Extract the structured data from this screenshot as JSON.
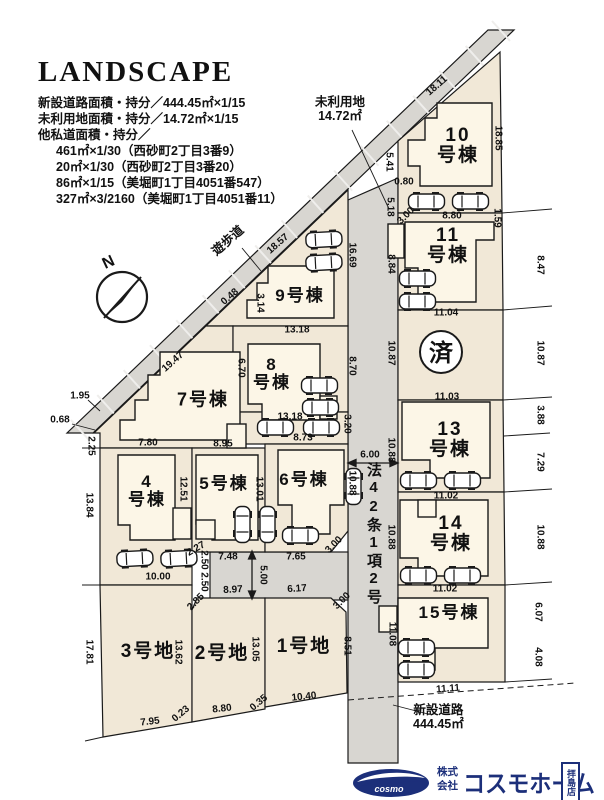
{
  "header": {
    "title": "LANDSCAPE",
    "lines": [
      "新設道路面積・持分／444.45㎡×1/15",
      "未利用地面積・持分／14.72㎡×1/15",
      "他私道面積・持分／",
      "461㎡×1/30（西砂町2丁目3番9）",
      "20㎡×1/30（西砂町2丁目3番20）",
      "86㎡×1/15（美堀町1丁目4051番547）",
      "327㎡×3/2160（美堀町1丁目4051番11）"
    ]
  },
  "plan": {
    "north_label": "N",
    "walkway_label": "遊歩道",
    "unused_label_1": "未利用地",
    "unused_label_2": "14.72㎡",
    "road42_label": "法42条1項2号",
    "newroad_label_1": "新設道路",
    "newroad_label_2": "444.45㎡",
    "sold_label": "済",
    "colors": {
      "lot": "#f1e8d7",
      "road": "#d8d6d1",
      "house": "#fcf6e7",
      "line": "#1a1a1a",
      "logo_navy": "#1c2f7a"
    },
    "parcels": [
      {
        "lines": [
          "10",
          "号棟"
        ],
        "x": 458,
        "y": 146,
        "size": 19
      },
      {
        "lines": [
          "11",
          "号棟"
        ],
        "x": 448,
        "y": 246,
        "size": 19
      },
      {
        "lines": [
          "13",
          "号棟"
        ],
        "x": 450,
        "y": 440,
        "size": 19
      },
      {
        "lines": [
          "14",
          "号棟"
        ],
        "x": 451,
        "y": 534,
        "size": 19
      },
      {
        "lines": [
          "15号棟"
        ],
        "x": 449,
        "y": 613,
        "size": 17
      },
      {
        "lines": [
          "9号棟"
        ],
        "x": 300,
        "y": 296,
        "size": 17
      },
      {
        "lines": [
          "8",
          "号棟"
        ],
        "x": 272,
        "y": 374,
        "size": 17
      },
      {
        "lines": [
          "7号棟"
        ],
        "x": 203,
        "y": 400,
        "size": 18
      },
      {
        "lines": [
          "4",
          "号棟"
        ],
        "x": 147,
        "y": 491,
        "size": 17
      },
      {
        "lines": [
          "5号棟"
        ],
        "x": 224,
        "y": 484,
        "size": 17
      },
      {
        "lines": [
          "6号棟"
        ],
        "x": 304,
        "y": 480,
        "size": 17
      },
      {
        "lines": [
          "3号地"
        ],
        "x": 148,
        "y": 652,
        "size": 19
      },
      {
        "lines": [
          "2号地"
        ],
        "x": 222,
        "y": 654,
        "size": 19
      },
      {
        "lines": [
          "1号地"
        ],
        "x": 304,
        "y": 647,
        "size": 19
      }
    ],
    "dimensions": [
      {
        "t": "18.11",
        "x": 437,
        "y": 86,
        "r": -41
      },
      {
        "t": "18.57",
        "x": 278,
        "y": 244,
        "r": -41
      },
      {
        "t": "0.48",
        "x": 230,
        "y": 297,
        "r": -41
      },
      {
        "t": "19.47",
        "x": 173,
        "y": 362,
        "r": -41
      },
      {
        "t": "1.95",
        "x": 80,
        "y": 396,
        "r": 0
      },
      {
        "t": "0.68",
        "x": 60,
        "y": 420,
        "r": 0
      },
      {
        "t": "2.25",
        "x": 91,
        "y": 446,
        "r": 90
      },
      {
        "t": "13.84",
        "x": 89,
        "y": 505,
        "r": 90
      },
      {
        "t": "17.81",
        "x": 89,
        "y": 652,
        "r": 90
      },
      {
        "t": "7.95",
        "x": 150,
        "y": 722,
        "r": -6
      },
      {
        "t": "0.23",
        "x": 181,
        "y": 714,
        "r": -40
      },
      {
        "t": "8.80",
        "x": 222,
        "y": 709,
        "r": -6
      },
      {
        "t": "0.35",
        "x": 259,
        "y": 703,
        "r": -40
      },
      {
        "t": "10.40",
        "x": 304,
        "y": 697,
        "r": -6
      },
      {
        "t": "13.62",
        "x": 178,
        "y": 652,
        "r": 90
      },
      {
        "t": "13.05",
        "x": 255,
        "y": 649,
        "r": 90
      },
      {
        "t": "8.51",
        "x": 347,
        "y": 646,
        "r": 90
      },
      {
        "t": "2.85",
        "x": 196,
        "y": 602,
        "r": -45
      },
      {
        "t": "3.00",
        "x": 342,
        "y": 601,
        "r": -45
      },
      {
        "t": "6.17",
        "x": 297,
        "y": 589,
        "r": -4
      },
      {
        "t": "8.97",
        "x": 233,
        "y": 590,
        "r": -3
      },
      {
        "t": "7.48",
        "x": 228,
        "y": 557,
        "r": 0
      },
      {
        "t": "7.65",
        "x": 296,
        "y": 557,
        "r": 0
      },
      {
        "t": "5.00",
        "x": 263,
        "y": 575,
        "r": 90
      },
      {
        "t": "2.50",
        "x": 204,
        "y": 560,
        "r": 90
      },
      {
        "t": "2.50",
        "x": 204,
        "y": 582,
        "r": 90
      },
      {
        "t": "10.00",
        "x": 158,
        "y": 577,
        "r": 0
      },
      {
        "t": "2.27",
        "x": 196,
        "y": 549,
        "r": -30
      },
      {
        "t": "7.80",
        "x": 148,
        "y": 443,
        "r": 0
      },
      {
        "t": "8.95",
        "x": 223,
        "y": 444,
        "r": 0
      },
      {
        "t": "8.73",
        "x": 303,
        "y": 438,
        "r": 0
      },
      {
        "t": "12.51",
        "x": 183,
        "y": 489,
        "r": 90
      },
      {
        "t": "13.01",
        "x": 259,
        "y": 489,
        "r": 90
      },
      {
        "t": "3.00",
        "x": 334,
        "y": 545,
        "r": -45
      },
      {
        "t": "3.20",
        "x": 347,
        "y": 424,
        "r": 90
      },
      {
        "t": "10.88",
        "x": 352,
        "y": 483,
        "r": 90
      },
      {
        "t": "6.00",
        "x": 370,
        "y": 455,
        "r": 0
      },
      {
        "t": "3.14",
        "x": 260,
        "y": 303,
        "r": 90
      },
      {
        "t": "13.18",
        "x": 297,
        "y": 330,
        "r": 0
      },
      {
        "t": "13.18",
        "x": 290,
        "y": 417,
        "r": 0
      },
      {
        "t": "6.70",
        "x": 241,
        "y": 368,
        "r": 90
      },
      {
        "t": "8.70",
        "x": 352,
        "y": 366,
        "r": 90
      },
      {
        "t": "16.69",
        "x": 352,
        "y": 255,
        "r": 90
      },
      {
        "t": "5.41",
        "x": 389,
        "y": 162,
        "r": 90
      },
      {
        "t": "0.80",
        "x": 404,
        "y": 182,
        "r": 0
      },
      {
        "t": "5.18",
        "x": 390,
        "y": 207,
        "r": 90
      },
      {
        "t": "3.00",
        "x": 406,
        "y": 216,
        "r": -45
      },
      {
        "t": "8.84",
        "x": 391,
        "y": 264,
        "r": 90
      },
      {
        "t": "10.87",
        "x": 391,
        "y": 353,
        "r": 90
      },
      {
        "t": "10.88",
        "x": 391,
        "y": 450,
        "r": 90
      },
      {
        "t": "10.88",
        "x": 391,
        "y": 537,
        "r": 90
      },
      {
        "t": "11.08",
        "x": 392,
        "y": 634,
        "r": 90
      },
      {
        "t": "18.85",
        "x": 498,
        "y": 138,
        "r": 90
      },
      {
        "t": "1.59",
        "x": 497,
        "y": 218,
        "r": 90
      },
      {
        "t": "8.47",
        "x": 540,
        "y": 265,
        "r": 90
      },
      {
        "t": "10.87",
        "x": 540,
        "y": 353,
        "r": 90
      },
      {
        "t": "3.88",
        "x": 540,
        "y": 415,
        "r": 90
      },
      {
        "t": "7.29",
        "x": 540,
        "y": 462,
        "r": 90
      },
      {
        "t": "10.88",
        "x": 540,
        "y": 537,
        "r": 90
      },
      {
        "t": "6.07",
        "x": 538,
        "y": 612,
        "r": 90
      },
      {
        "t": "4.08",
        "x": 538,
        "y": 657,
        "r": 90
      },
      {
        "t": "8.80",
        "x": 452,
        "y": 216,
        "r": 0
      },
      {
        "t": "11.04",
        "x": 446,
        "y": 313,
        "r": 0
      },
      {
        "t": "11.03",
        "x": 447,
        "y": 397,
        "r": 0
      },
      {
        "t": "11.02",
        "x": 446,
        "y": 496,
        "r": 0
      },
      {
        "t": "11.02",
        "x": 445,
        "y": 589,
        "r": 0
      },
      {
        "t": "11.11",
        "x": 448,
        "y": 689,
        "r": -4
      }
    ]
  },
  "footer": {
    "logo_text": "cosmo",
    "company_prefix_1": "株式",
    "company_prefix_2": "会社",
    "company_name": "コスモホーム",
    "branch": "拝島店"
  }
}
